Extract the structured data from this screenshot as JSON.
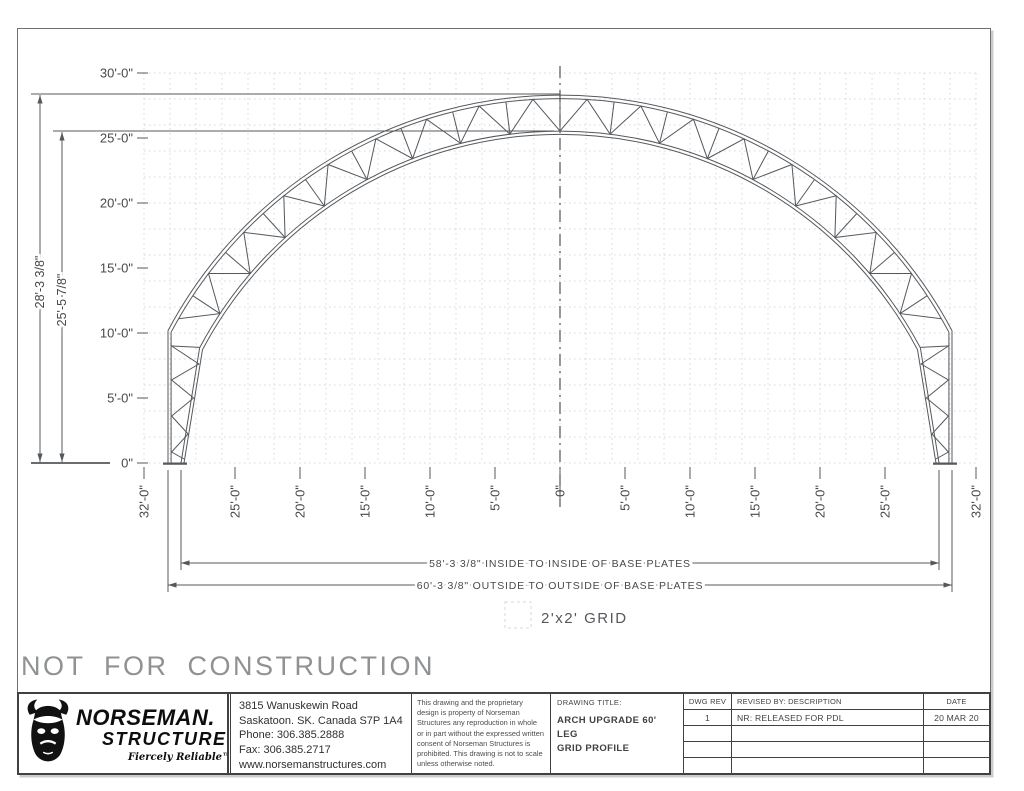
{
  "colors": {
    "line": "#55585c",
    "grid": "#d4d7da",
    "watermark": "#8f9193",
    "text": "#46484b"
  },
  "watermark": "NOT FOR CONSTRUCTION",
  "drawing": {
    "y_axis_labels": [
      "30'-0\"",
      "25'-0\"",
      "20'-0\"",
      "15'-0\"",
      "10'-0\"",
      "5'-0\"",
      "0\""
    ],
    "x_axis_labels": [
      "32'-0\"",
      "25'-0\"",
      "20'-0\"",
      "15'-0\"",
      "10'-0\"",
      "5'-0\"",
      "0\"",
      "5'-0\"",
      "10'-0\"",
      "15'-0\"",
      "20'-0\"",
      "25'-0\"",
      "32'-0\""
    ],
    "height_outside": "28'-3 3/8\"",
    "height_inside": "25'-5 7/8\"",
    "dim_inside": "58'-3 3/8\" INSIDE TO INSIDE OF BASE PLATES",
    "dim_outside": "60'-3 3/8\" OUTSIDE TO OUTSIDE OF BASE PLATES",
    "grid_legend": "2'x2' GRID"
  },
  "title_block": {
    "logo": {
      "name_line1": "NORSEMAN.",
      "name_line2": "STRUCTURES",
      "tagline": "Fiercely Reliable™"
    },
    "address": [
      "3815 Wanuskewin Road",
      "Saskatoon. SK. Canada S7P 1A4",
      "Phone: 306.385.2888",
      "Fax: 306.385.2717",
      "www.norsemanstructures.com"
    ],
    "disclaimer": "This drawing and the proprietary design is property of Norseman Structures any reproduction in whole or in part without the expressed written consent of Norseman Structures is prohibited. This drawing is not to scale unless otherwise noted.",
    "drawing_title_label": "DRAWING TITLE:",
    "drawing_title_line1": "ARCH UPGRADE 60' LEG",
    "drawing_title_line2": "GRID PROFILE",
    "headers": {
      "dwg_rev": "DWG REV",
      "revised_by": "REVISED BY: DESCRIPTION",
      "date": "DATE"
    },
    "revisions": [
      {
        "rev": "1",
        "description": "NR: RELEASED FOR PDL",
        "date": "20 MAR 20"
      }
    ]
  }
}
